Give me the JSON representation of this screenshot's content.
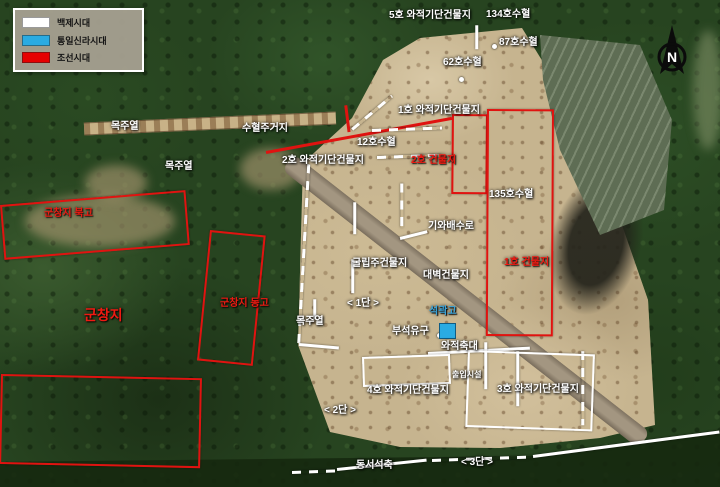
{
  "legend": {
    "items": [
      {
        "label": "백제시대",
        "color": "#ffffff"
      },
      {
        "label": "통일신라시대",
        "color": "#2aabe2"
      },
      {
        "label": "조선시대",
        "color": "#e60000"
      }
    ]
  },
  "compass": {
    "label": "N"
  },
  "colors": {
    "red_annotation": "#e01310",
    "white_annotation": "#ffffff",
    "blue_label": "#39a4da",
    "silla_fill": "#2aabe2"
  },
  "map": {
    "labels": [
      {
        "text": "5호 와적기단건물지",
        "x": 389,
        "y": 10,
        "color": "white"
      },
      {
        "text": "134호수혈",
        "x": 486,
        "y": 9,
        "color": "white"
      },
      {
        "text": "87호수혈",
        "x": 499,
        "y": 37,
        "color": "white"
      },
      {
        "text": "62호수혈",
        "x": 443,
        "y": 57,
        "color": "white"
      },
      {
        "text": "목주열",
        "x": 111,
        "y": 121,
        "color": "white"
      },
      {
        "text": "수혈주거지",
        "x": 242,
        "y": 123,
        "color": "white"
      },
      {
        "text": "목주열",
        "x": 165,
        "y": 161,
        "color": "white"
      },
      {
        "text": "1호 와적기단건물지",
        "x": 398,
        "y": 105,
        "color": "white"
      },
      {
        "text": "12호수혈",
        "x": 357,
        "y": 137,
        "color": "white"
      },
      {
        "text": "2호 와적기단건물지",
        "x": 282,
        "y": 155,
        "color": "white"
      },
      {
        "text": "2호 건물지",
        "x": 411,
        "y": 155,
        "color": "red"
      },
      {
        "text": "135호수혈",
        "x": 489,
        "y": 189,
        "color": "white"
      },
      {
        "text": "기와배수로",
        "x": 428,
        "y": 221,
        "color": "white"
      },
      {
        "text": "굴립주건물지",
        "x": 352,
        "y": 258,
        "color": "white"
      },
      {
        "text": "대벽건물지",
        "x": 423,
        "y": 270,
        "color": "white"
      },
      {
        "text": "1호 건물지",
        "x": 504,
        "y": 257,
        "color": "red"
      },
      {
        "text": "군창지 북고",
        "x": 44,
        "y": 208,
        "color": "red"
      },
      {
        "text": "군창지 동고",
        "x": 220,
        "y": 298,
        "color": "red"
      },
      {
        "text": "군창지",
        "x": 84,
        "y": 307,
        "color": "red",
        "size": 14
      },
      {
        "text": "< 1단 >",
        "x": 347,
        "y": 298,
        "color": "white"
      },
      {
        "text": "목주열",
        "x": 296,
        "y": 316,
        "color": "white"
      },
      {
        "text": "석곽고",
        "x": 429,
        "y": 306,
        "color": "blue"
      },
      {
        "text": "부석유구",
        "x": 392,
        "y": 326,
        "color": "white"
      },
      {
        "text": "와적축대",
        "x": 441,
        "y": 341,
        "color": "white"
      },
      {
        "text": "출입시설",
        "x": 452,
        "y": 370,
        "color": "white",
        "size": 8
      },
      {
        "text": "4호 와적기단건물지",
        "x": 367,
        "y": 385,
        "color": "white"
      },
      {
        "text": "3호 와적기단건물지",
        "x": 497,
        "y": 384,
        "color": "white"
      },
      {
        "text": "< 2단 >",
        "x": 324,
        "y": 405,
        "color": "white"
      },
      {
        "text": "동서석축",
        "x": 356,
        "y": 460,
        "color": "white"
      },
      {
        "text": "< 3단 >",
        "x": 461,
        "y": 457,
        "color": "white"
      }
    ],
    "red_boxes": [
      {
        "x": 0,
        "y": 205,
        "w": 186,
        "h": 55,
        "rot": -4.6
      },
      {
        "x": 210,
        "y": 230,
        "w": 56,
        "h": 131,
        "rot": 5.7
      },
      {
        "x": 1,
        "y": 374,
        "w": 201,
        "h": 90,
        "rot": 1.2
      },
      {
        "x": 452,
        "y": 114,
        "w": 36,
        "h": 80,
        "rot": 0.5
      },
      {
        "x": 487,
        "y": 109,
        "w": 67,
        "h": 227,
        "rot": 0.3
      }
    ],
    "red_lines": [
      {
        "x": 266,
        "y": 151,
        "len": 189,
        "rot": -10.4
      },
      {
        "x": 346,
        "y": 104,
        "len": 27,
        "rot": 83
      }
    ],
    "white_lines": [
      {
        "x": 477,
        "y": 24,
        "len": 24,
        "rot": 90,
        "dashed": false
      },
      {
        "x": 372,
        "y": 129,
        "len": 70,
        "rot": -2,
        "dashed": true
      },
      {
        "x": 377,
        "y": 156,
        "len": 64,
        "rot": -2,
        "dashed": true
      },
      {
        "x": 309,
        "y": 163,
        "len": 180,
        "rot": 93.2,
        "dashed": true
      },
      {
        "x": 352,
        "y": 128,
        "len": 52,
        "rot": -40,
        "dashed": true
      },
      {
        "x": 400,
        "y": 237,
        "len": 28,
        "rot": -14,
        "dashed": false
      },
      {
        "x": 402,
        "y": 182,
        "len": 44,
        "rot": 90,
        "dashed": true
      },
      {
        "x": 355,
        "y": 201,
        "len": 32,
        "rot": 90,
        "dashed": false
      },
      {
        "x": 353,
        "y": 258,
        "len": 34,
        "rot": 90,
        "dashed": false
      },
      {
        "x": 428,
        "y": 352,
        "len": 102,
        "rot": -3,
        "dashed": false
      },
      {
        "x": 486,
        "y": 341,
        "len": 47,
        "rot": 90,
        "dashed": false
      },
      {
        "x": 518,
        "y": 350,
        "len": 55,
        "rot": 90,
        "dashed": false
      },
      {
        "x": 583,
        "y": 350,
        "len": 74,
        "rot": 90,
        "dashed": true
      },
      {
        "x": 315,
        "y": 298,
        "len": 20,
        "rot": 90,
        "dashed": false
      },
      {
        "x": 299,
        "y": 343,
        "len": 40,
        "rot": 5,
        "dashed": false
      },
      {
        "x": 292,
        "y": 471,
        "len": 45,
        "rot": -2,
        "dashed": true
      },
      {
        "x": 337,
        "y": 468,
        "len": 90,
        "rot": -6,
        "dashed": false
      },
      {
        "x": 432,
        "y": 459,
        "len": 100,
        "rot": -2,
        "dashed": true
      },
      {
        "x": 533,
        "y": 455,
        "len": 188,
        "rot": -7.5,
        "dashed": false
      }
    ],
    "white_rects": [
      {
        "x": 362,
        "y": 357,
        "w": 88,
        "h": 30,
        "rot": -2
      },
      {
        "x": 468,
        "y": 350,
        "w": 127,
        "h": 77,
        "rot": 2
      }
    ],
    "dots": [
      {
        "x": 492,
        "y": 44
      },
      {
        "x": 459,
        "y": 77
      },
      {
        "x": 437,
        "y": 333
      }
    ],
    "silla_feature": {
      "x": 439,
      "y": 323,
      "w": 17,
      "h": 16
    }
  }
}
